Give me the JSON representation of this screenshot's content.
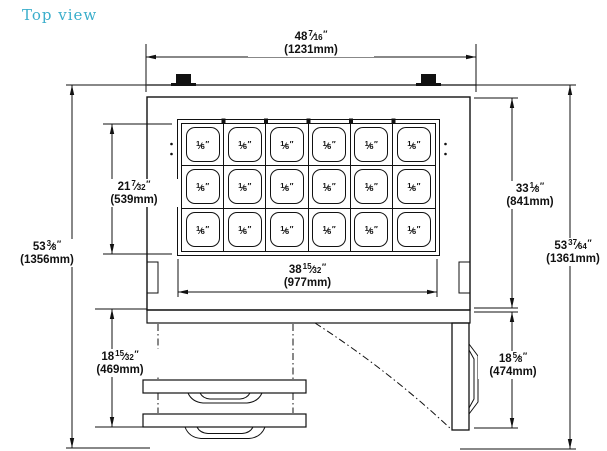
{
  "title": {
    "text": "Top view"
  },
  "colors": {
    "title_accent": "#3aaecb",
    "line": "#111111"
  },
  "pan_grid": {
    "cols": 6,
    "rows": 3,
    "pan": {
      "num": "1",
      "den": "6",
      "unit": "″"
    }
  },
  "dims": {
    "top": {
      "whole": "48",
      "num": "7",
      "den": "16",
      "unit": "″",
      "mm": "(1231mm)"
    },
    "left_inner": {
      "whole": "21",
      "num": "7",
      "den": "32",
      "unit": "″",
      "mm": "(539mm)"
    },
    "left_outer": {
      "whole": "53",
      "num": "3",
      "den": "8",
      "unit": "″",
      "mm": "(1356mm)"
    },
    "right_inner": {
      "whole": "33",
      "num": "1",
      "den": "8",
      "unit": "″",
      "mm": "(841mm)"
    },
    "right_outer": {
      "whole": "53",
      "num": "37",
      "den": "64",
      "unit": "″",
      "mm": "(1361mm)"
    },
    "bottom_center": {
      "whole": "38",
      "num": "15",
      "den": "32",
      "unit": "″",
      "mm": "(977mm)"
    },
    "bottom_left": {
      "whole": "18",
      "num": "15",
      "den": "32",
      "unit": "″",
      "mm": "(469mm)"
    },
    "bottom_right": {
      "whole": "18",
      "num": "5",
      "den": "8",
      "unit": "″",
      "mm": "(474mm)"
    }
  }
}
